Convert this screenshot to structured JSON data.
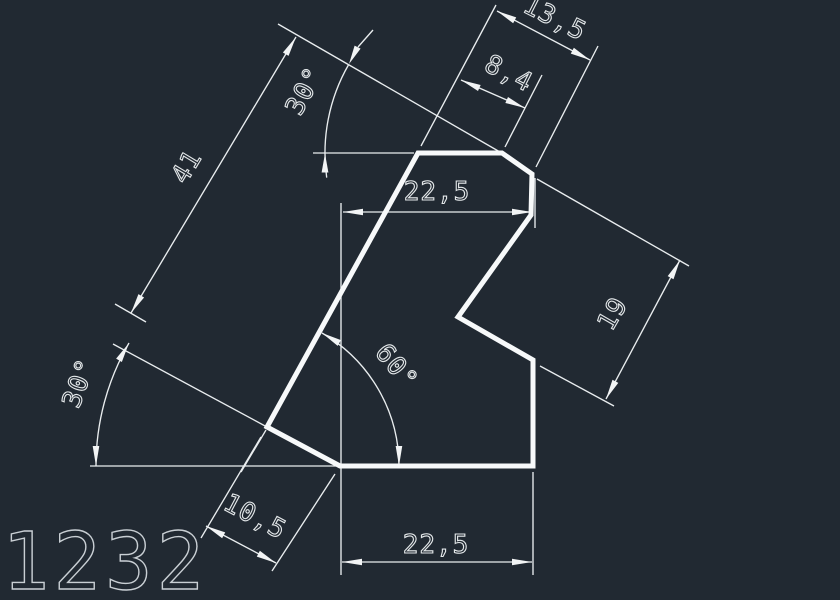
{
  "palette": {
    "background": "#212932",
    "outline_color": "#f7f9fa",
    "dimension_line_color": "#e9edef",
    "dimension_text_color": "#e4e8ea",
    "drawing_number_color": "#c9cfd4"
  },
  "drawing": {
    "number": "1232"
  },
  "dims": {
    "top_chamfer_span": "13,5",
    "top_edge_width": "8,4",
    "upper_width": "22,5",
    "slant_edge_length": "41",
    "top_angle": "30°",
    "left_chamfer_angle": "30°",
    "base_slant_angle": "60°",
    "notch_offset": "19",
    "chamfer_length": "10,5",
    "bottom_width": "22,5"
  }
}
